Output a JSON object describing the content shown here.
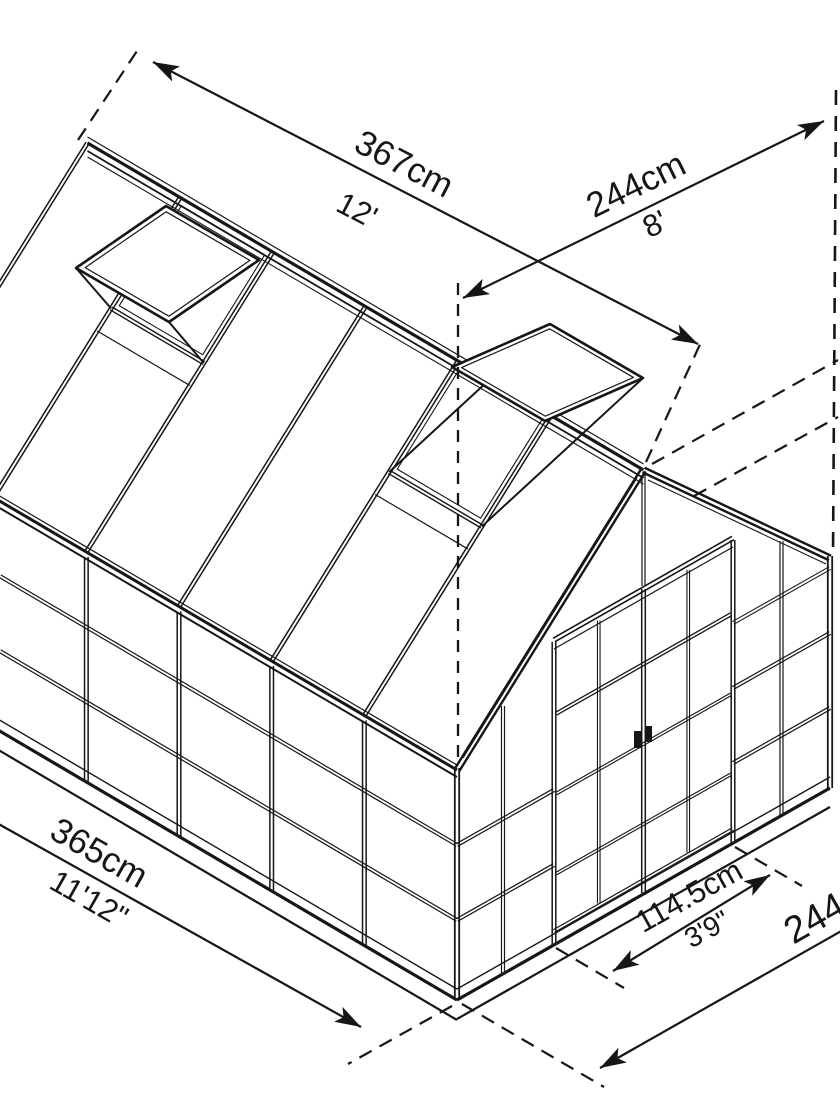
{
  "page": {
    "background": "#ffffff",
    "line_color": "#161616"
  },
  "diagram": {
    "type": "isometric-greenhouse-dimension-drawing",
    "dimensions": {
      "ridge_length": {
        "cm": "367cm",
        "imperial": "12'"
      },
      "gable_width": {
        "cm": "244cm",
        "imperial": "8'"
      },
      "side_length": {
        "cm": "365cm",
        "imperial": "11'12\""
      },
      "door_width": {
        "cm": "114.5cm",
        "imperial": "3'9\""
      },
      "base_width": {
        "cm": "244cm"
      }
    },
    "features": [
      "gable roof with ridge",
      "two open roof vents",
      "double sliding front doors",
      "glazed panel walls",
      "dashed extension lines with double-headed dimension arrows"
    ]
  }
}
